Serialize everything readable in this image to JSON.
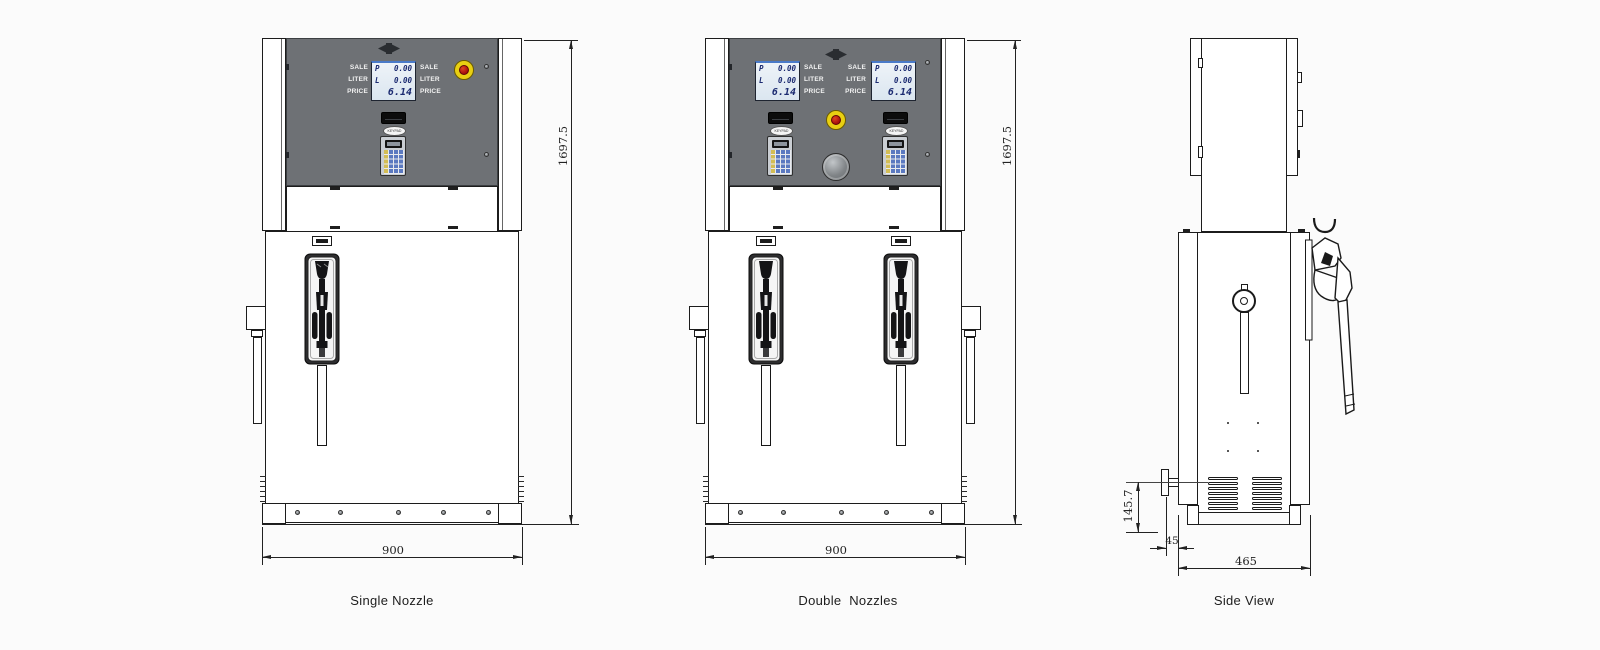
{
  "colors": {
    "background": "#fbfbfb",
    "line": "#1c1c1c",
    "panel_gray": "#6e7175",
    "lcd_text_blue": "#1b2a70",
    "lcd_accent_blue": "#4a7ac8",
    "estop_yellow": "#e9cf12",
    "estop_red": "#a50e0e",
    "keypad_yellow": "#d3bd55",
    "keypad_blue": "#5b79c0"
  },
  "lcd": {
    "rows": [
      {
        "label": "P",
        "value": "0.00"
      },
      {
        "label": "L",
        "value": "0.00"
      }
    ],
    "price": "6.14",
    "side_labels": [
      "SALE",
      "LITER",
      "PRICE"
    ]
  },
  "keypad": {
    "label": "KEYPAD"
  },
  "views": {
    "single": {
      "caption": "Single Nozzle",
      "height_mm": "1697.5",
      "width_mm": "900"
    },
    "double": {
      "caption": "Double  Nozzles",
      "height_mm": "1697.5",
      "width_mm": "900"
    },
    "side": {
      "caption": "Side View",
      "depth_mm": "465",
      "inlet_height_mm": "145.7",
      "inlet_offset_mm": "45"
    }
  }
}
